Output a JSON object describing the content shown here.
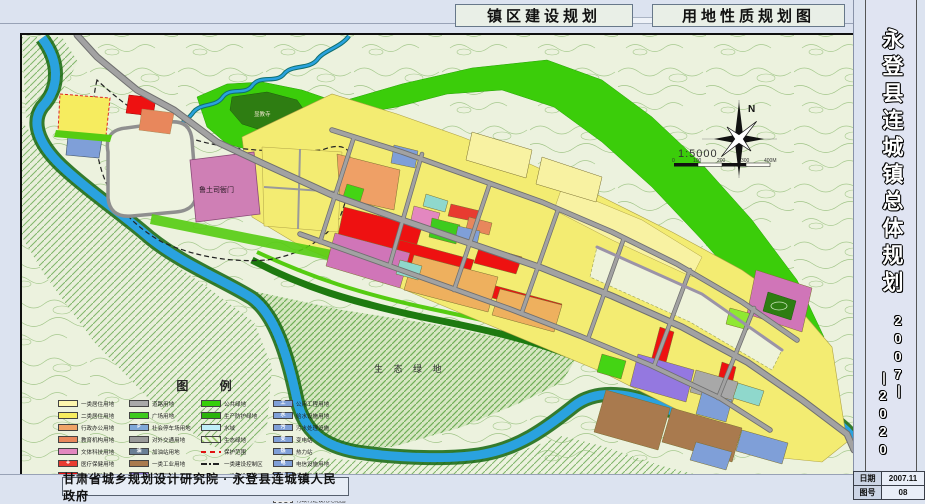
{
  "page_titles": {
    "left": "镇区建设规划",
    "right": "用地性质规划图"
  },
  "sidebar": {
    "title": "永登县连城镇总体规划",
    "years_right": "2007丨",
    "years_left": "丨2020"
  },
  "footer": {
    "attribution": "甘肃省城乡规划设计研究院 · 永登县连城镇人民政府"
  },
  "title_block": {
    "rows": [
      {
        "label": "日期",
        "value": "2007.11"
      },
      {
        "label": "图号",
        "value": "08"
      }
    ]
  },
  "map_labels": {
    "heritage": "鲁土司衙门",
    "temple": "显教寺",
    "eco_green": "生 态 绿 地"
  },
  "compass": {
    "north": "N"
  },
  "scale": {
    "ratio": "1:5000",
    "ticks": [
      "0",
      "100",
      "200",
      "300",
      "400M"
    ]
  },
  "legend": {
    "title": "图 例",
    "columns": [
      {
        "items": [
          {
            "label": "一类居住用地",
            "type": "solid",
            "color": "#fdf6ae"
          },
          {
            "label": "二类居住用地",
            "type": "solid",
            "color": "#f6ec5f"
          },
          {
            "label": "行政办公用地",
            "type": "solid",
            "color": "#f0a468"
          },
          {
            "label": "教育机构用地",
            "type": "solid",
            "color": "#e8875c"
          },
          {
            "label": "文体科技用地",
            "type": "solid",
            "color": "#e387c0"
          },
          {
            "label": "医疗保健用地",
            "type": "solid",
            "color": "#e83b30",
            "glyph": "✚"
          },
          {
            "label": "商业金融用地",
            "type": "solid",
            "color": "#ee1111"
          },
          {
            "label": "集贸市场用地",
            "type": "solid",
            "color": "#cc1f1f"
          }
        ]
      },
      {
        "items": [
          {
            "label": "道路用地",
            "type": "solid",
            "color": "#a9a9a9"
          },
          {
            "label": "广场用地",
            "type": "solid",
            "color": "#3ecb1e"
          },
          {
            "label": "社会停车场用地",
            "type": "solid",
            "color": "#7fa8d8",
            "glyph": "P"
          },
          {
            "label": "对外交通用地",
            "type": "solid",
            "color": "#9a9a9a"
          },
          {
            "label": "加油站用地",
            "type": "solid",
            "color": "#6a7f95",
            "glyph": "油"
          },
          {
            "label": "一类工业用地",
            "type": "solid",
            "color": "#a97a4e"
          },
          {
            "label": "仓储用地",
            "type": "solid",
            "color": "#9478e0"
          },
          {
            "label": "市场用地",
            "type": "solid",
            "color": "#ddb87a"
          }
        ]
      },
      {
        "items": [
          {
            "label": "公共绿地",
            "type": "solid",
            "color": "#35cf08"
          },
          {
            "label": "生产防护绿地",
            "type": "solid",
            "color": "#2bb40a"
          },
          {
            "label": "水域",
            "type": "solid",
            "color": "#bfeef8"
          },
          {
            "label": "生态绿地",
            "type": "hatch",
            "color": "#9cc66e"
          },
          {
            "label": "保护范围",
            "type": "dash-red",
            "color": "#e11111"
          },
          {
            "label": "一类建设控制区",
            "type": "dashdot",
            "color": "#222222"
          },
          {
            "label": "二类建设控制区",
            "type": "dash",
            "color": "#222222"
          },
          {
            "label": "工程设施用地",
            "type": "solid",
            "color": "#7f9fd8"
          }
        ]
      },
      {
        "items": [
          {
            "label": "公用工程用地",
            "type": "solid",
            "color": "#7f9fd8",
            "glyph": "工"
          },
          {
            "label": "给水设施用地",
            "type": "solid",
            "color": "#7f9fd8",
            "glyph": "水"
          },
          {
            "label": "污水处理设施",
            "type": "solid",
            "color": "#7f9fd8",
            "glyph": "污"
          },
          {
            "label": "变电站",
            "type": "solid",
            "color": "#7f9fd8",
            "glyph": "变"
          },
          {
            "label": "热力站",
            "type": "solid",
            "color": "#7f9fd8",
            "glyph": "热"
          },
          {
            "label": "电信设施用地",
            "type": "solid",
            "color": "#7f9fd8",
            "glyph": "电"
          },
          {
            "label": "燃气设施用地",
            "type": "solid",
            "color": "#7f9fd8",
            "glyph": "气"
          },
          {
            "label": "环卫设施用地",
            "type": "solid",
            "color": "#7f9fd8",
            "glyph": "环"
          },
          {
            "label": "行政村建设用地范围",
            "type": "dashed-box",
            "color": "#ededed"
          }
        ]
      }
    ]
  },
  "colors": {
    "residential_yellow": "#f3ec72",
    "commercial_red": "#ee1111",
    "green_space": "#3bcd0a",
    "water_blue": "#2aa2df",
    "road_gray": "#a2a2a2",
    "heritage_pink": "#cf7fb5"
  }
}
